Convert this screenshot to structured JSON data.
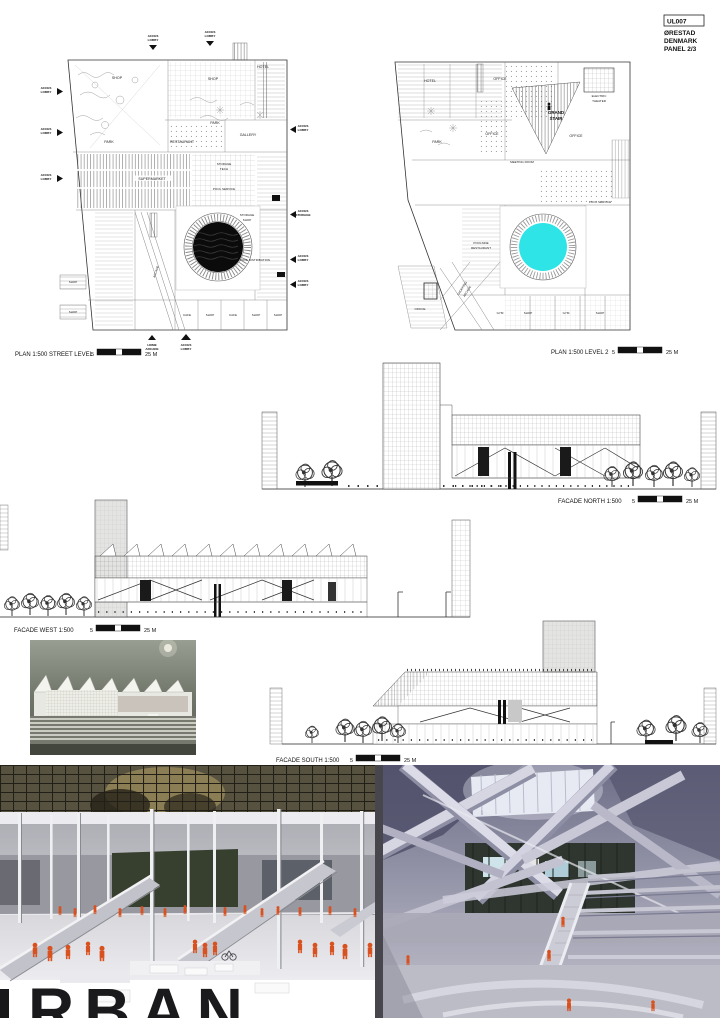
{
  "panel": {
    "code": "UL007",
    "line1": "ØRESTAD",
    "line2": "DENMARK",
    "line3": "PANEL 2/3"
  },
  "titles": {
    "plan1": "PLAN 1:500 STREET LEVEL",
    "plan2": "PLAN 1:500 LEVEL 2",
    "north": "FACADE NORTH 1:500",
    "west": "FACADE WEST 1:500",
    "south": "FACADE SOUTH 1:500"
  },
  "scale": {
    "near": "5",
    "far": "25 M"
  },
  "plan1": {
    "labels": [
      "SHOP",
      "SHOP",
      "HOTEL",
      "PARK",
      "RESTAURANT",
      "PARK",
      "GALLERY",
      "SUPERMARKET",
      "STORAGE",
      "TECH",
      "POOL SERVICE",
      "STORAGE",
      "SHOP",
      "POOL DISTRIBUTION",
      "SHOP",
      "SHOP",
      "ARCADE",
      "CAFE",
      "SHOP",
      "CAFE",
      "SHOP",
      "SHOP"
    ],
    "access": [
      [
        "ACCES",
        "LOBBY"
      ],
      [
        "ACCES",
        "LOBBY"
      ],
      [
        "ACCES",
        "LOBBY"
      ],
      [
        "ACCES",
        "LOBBY"
      ],
      [
        "ACCES",
        "LOBBY"
      ],
      [
        "ACCES",
        "LOBBY"
      ],
      [
        "ACCES",
        "STORAGE"
      ],
      [
        "ACCES",
        "LOBBY"
      ],
      [
        "ACCES",
        "LOBBY"
      ],
      [
        "HOME",
        "ARCADE"
      ],
      [
        "ACCES",
        "LOBBY"
      ]
    ]
  },
  "plan2": {
    "labels": [
      "HOTEL",
      "OFFICE",
      "ELECTRIC",
      "THEATER",
      "PARK",
      "OFFICE",
      "GRAND",
      "STAIR",
      "OFFICE",
      "SHOPPING",
      "ARCADE",
      "MEETING ROOM",
      "POOLSIDE",
      "RESTAURANT",
      "POOL SERVICE",
      "OFFICE",
      "GYM",
      "SHOP",
      "GYM",
      "SHOP"
    ]
  },
  "photos": {
    "sign": "RBAN"
  },
  "colors": {
    "pool_street": "#0b0b0b",
    "pool_level2": "#2ee4e6",
    "figures": "#d8511f"
  }
}
